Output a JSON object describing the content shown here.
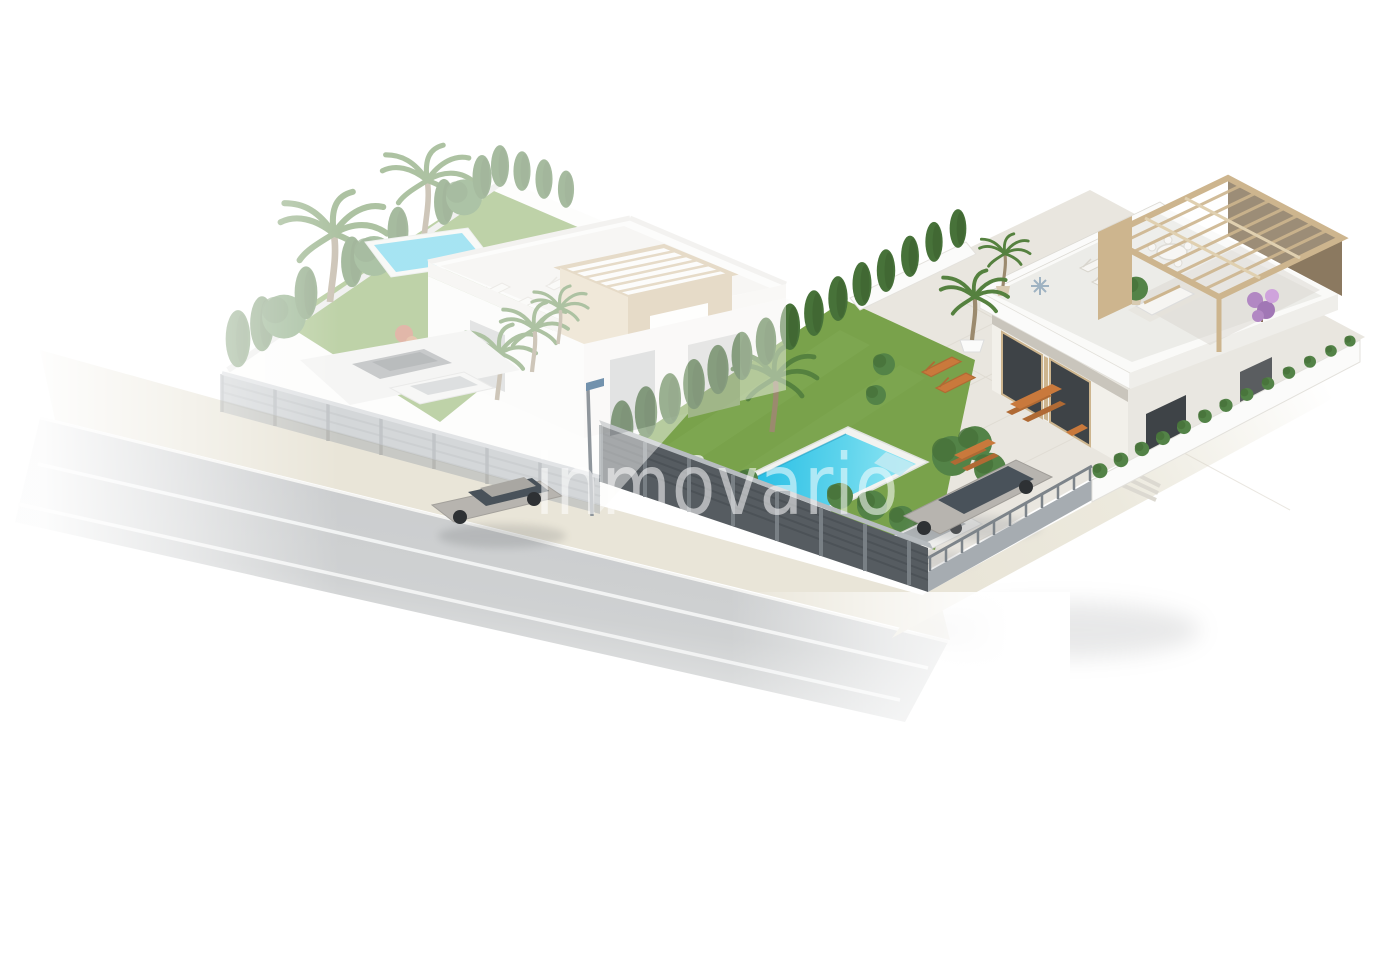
{
  "watermark": {
    "text": "inmovario",
    "color": "#ffffff",
    "opacity": 0.55
  },
  "scene": {
    "type": "3d-architectural-render",
    "view": "aerial-isometric-perspective",
    "description": "Real-estate visualization of two modern white villas on corner plots along a street: a faded villa with garden, small pool and parked cars on the left; a saturated villa with roof pergola terrace, paved patio, lawn garden with turquoise pool, hedges, dark street fence and two parked cars on the right; a silver sedan drives on the road; white translucent watermark across the middle",
    "elements": [
      "left-villa-plot-faded",
      "left-garden-pool",
      "left-roof-pergola-tower",
      "street-with-driving-car",
      "street-lamp",
      "front-garden-lawn",
      "swimming-pool",
      "cypress-boundary-hedge",
      "dark-street-fence",
      "driveway-fence",
      "right-boundary-hedge-wall",
      "right-villa",
      "roof-pergola",
      "roof-terrace-furniture",
      "patio-orange-furniture",
      "parked-silver-car",
      "parked-white-car",
      "bougainvillea",
      "palm-trees",
      "watermark"
    ]
  },
  "palette": {
    "background": "#ffffff",
    "asphalt": "#c7c9cb",
    "sidewalk": "#e9e5d8",
    "lane_line": "#f6f7f7",
    "lawn": "#79a24b",
    "lawn_light": "#8db55e",
    "hedge_dark": "#3c6030",
    "hedge_mid": "#477239",
    "hedge_light": "#538347",
    "pool_water": "#29bfe5",
    "pool_water_light": "#97e8f5",
    "pool_deck": "#f2f3f0",
    "villa_white": "#fafaf8",
    "villa_offwhite": "#efeeea",
    "soffit_shade": "#c9c5bc",
    "glass_dark": "#3e4347",
    "glass_faded": "#c3c5c5",
    "pergola_beige": "#cdb58e",
    "pergola_beige_light": "#e0d0b0",
    "pergola_brown": "#8b7960",
    "fence_dark": "#565c61",
    "fence_dark_line": "#484e53",
    "fence_cap": "#b7bcc0",
    "fence_post": "#7d848a",
    "fence_light": "#a6acb1",
    "wall_white": "#fbfbfa",
    "paving": "#e9e6df",
    "paving_line": "#d8d3c8",
    "terrace_paving": "#ecece8",
    "car_silver": "#b7b4af",
    "car_dark": "#8e9194",
    "car_white": "#efefed",
    "car_glass": "#49525a",
    "wheel": "#2e3134",
    "furniture_orange": "#c9793c",
    "furniture_orange_dark": "#b06a34",
    "furniture_white": "#f6f5f2",
    "flower_purple": "#b288c3",
    "flower_pink": "#cfa3dc",
    "trunk": "#9b8a6e",
    "palm_green": "#55813f",
    "lamp_gray": "#8f969c",
    "shadow": "#97999b",
    "watermark": "#ffffff"
  }
}
